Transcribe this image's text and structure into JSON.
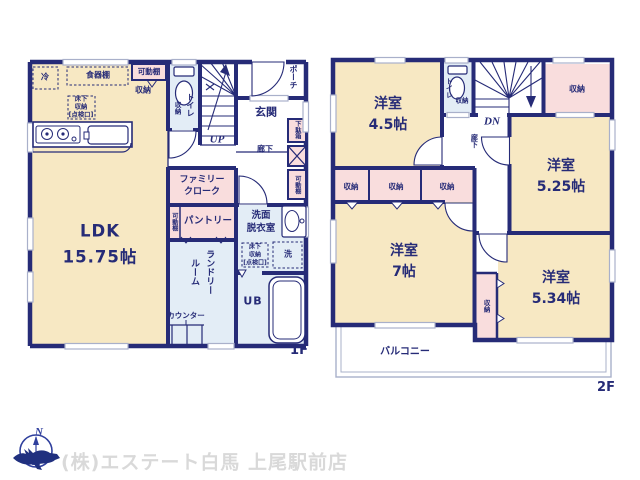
{
  "palette": {
    "wall_navy": "#262b77",
    "room_cream": "#f7e8c3",
    "closet_pink": "#f9dddd",
    "wet_blue": "#e3edf6",
    "window_gray": "#a9b0ca",
    "watermark_gray": "#d9d9d9",
    "logo_blue": "#2f3f9d"
  },
  "floor1": {
    "floor_label": "1F",
    "ldk": "LDK\n15.75帖",
    "kitchen": {
      "refrigerator": "冷",
      "dish_shelf": "食器棚",
      "movable_shelf": "可動棚",
      "storage": "収納",
      "underfloor": "床下\n収納\n[点検口]"
    },
    "toilet": {
      "label": "トイレ",
      "storage": "収納"
    },
    "stairs_up": "UP",
    "porch": "ポーチ",
    "entrance": "玄関",
    "shoe_box": "下駄箱",
    "hallway": "廊下",
    "movable_shelf_hall": "可動棚",
    "family_cloak": "ファミリー\nクローク",
    "pantry": "パントリー",
    "pantry_shelf": "可動棚",
    "washroom": {
      "label": "洗面\n脱衣室",
      "underfloor": "床下\n収納\n[点検口]",
      "washer": "洗"
    },
    "bath": "UB",
    "laundry": "ランドリー\nルーム",
    "counter": "カウンター"
  },
  "floor2": {
    "floor_label": "2F",
    "room_45": "洋室\n4.5帖",
    "room_525": "洋室\n5.25帖",
    "room_7": "洋室\n7帖",
    "room_534": "洋室\n5.34帖",
    "toilet": {
      "label": "トイレ",
      "storage": "収納"
    },
    "stairs_down": "DN",
    "hallway": "廊下",
    "storage_a": "収納",
    "storage_b": "収納",
    "storage_c": "収納",
    "storage_top_right": "収納",
    "storage_534": "収納",
    "balcony": "バルコニー"
  },
  "footer": {
    "compass_n": "N",
    "company": "(株)エステート白馬 上尾駅前店"
  }
}
